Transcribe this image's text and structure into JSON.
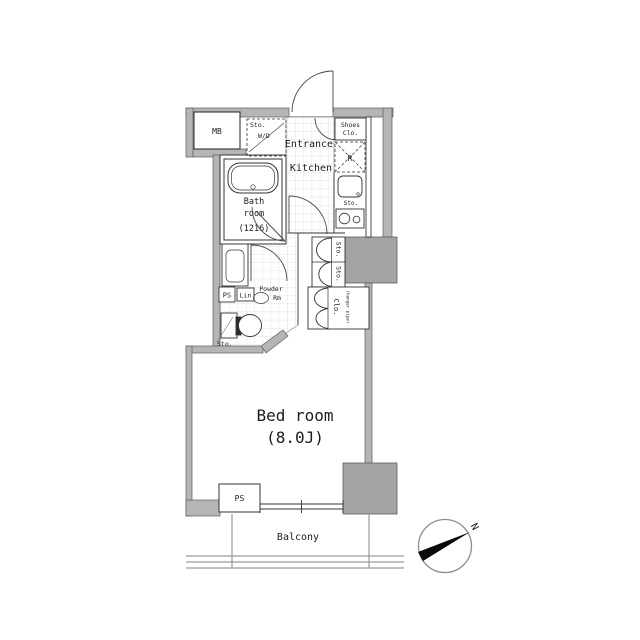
{
  "rooms": {
    "bedroom_name": "Bed room",
    "bedroom_size": "(8.0J)",
    "bath_line1": "Bath",
    "bath_line2": "room",
    "bath_line3": "(1216)",
    "entrance": "Entrance",
    "kitchen": "Kitchen",
    "balcony": "Balcony",
    "powder_line1": "Powder",
    "powder_line2": "Rm"
  },
  "fixtures": {
    "meter_box": "MB",
    "pipe_space_powder": "PS",
    "pipe_space_bottom": "PS",
    "linen": "Lin",
    "shoes_line1": "Shoes",
    "shoes_line2": "Clo.",
    "wd_line1": "Sto.",
    "wd_line2": "W/D",
    "fridge": "R",
    "sink_storage": "Sto.",
    "storage_top": "Sto.",
    "storage_bottom": "Sto.",
    "closet": "Clo.",
    "closet_note": "(hanger pipe)",
    "toilet_storage": "Sto.",
    "north": "N"
  },
  "colors": {
    "wall": "#b5b5b5",
    "column": "#a4a4a4",
    "line": "#2e2e2e",
    "tile_line": "#dcdcdc"
  }
}
